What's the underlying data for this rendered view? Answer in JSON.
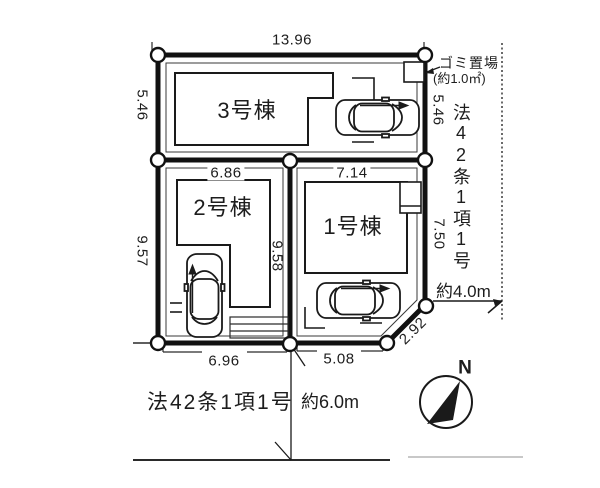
{
  "plan": {
    "title": "site-plan",
    "buildings": [
      {
        "id": "building-1",
        "label": "1号棟"
      },
      {
        "id": "building-2",
        "label": "2号棟"
      },
      {
        "id": "building-3",
        "label": "3号棟"
      }
    ],
    "dimensions": {
      "top": "13.96",
      "left_upper": "5.46",
      "left_lower": "9.57",
      "right_upper": "5.46",
      "right_lower": "7.50",
      "b2_width": "6.86",
      "b1_width": "7.14",
      "center_vertical": "9.58",
      "bottom_left": "6.96",
      "bottom_right": "5.08",
      "diagonal": "2.92"
    },
    "annotations": {
      "garbage_line1": "ゴミ置場",
      "garbage_line2": "(約1.0㎡)",
      "road_right_class": "法42条1項1号",
      "road_right_width": "約4.0m",
      "road_bottom_class": "法42条1項1号",
      "road_bottom_width": "約6.0m",
      "compass_north": "N"
    },
    "colors": {
      "line": "#1a1a1a",
      "background": "#ffffff"
    }
  }
}
